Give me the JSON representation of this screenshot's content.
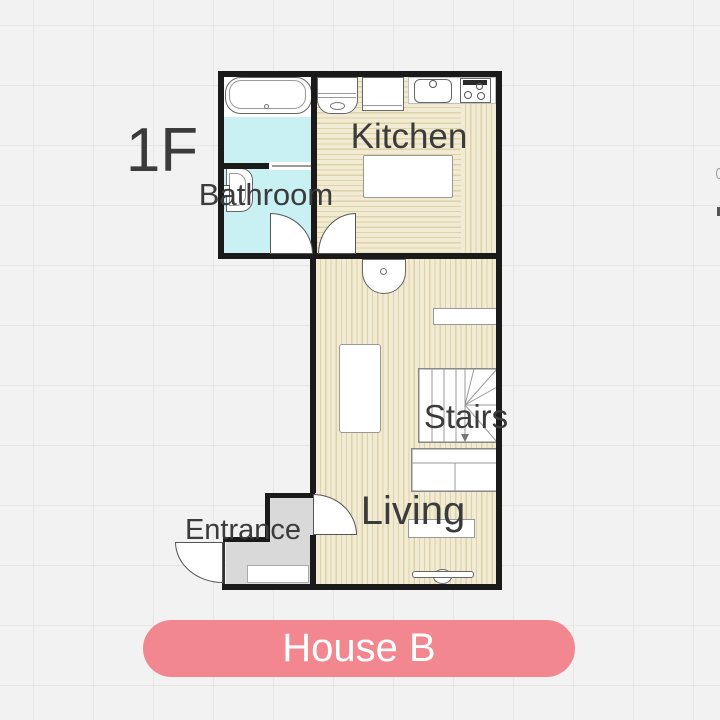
{
  "floor_plan": {
    "floor_label": "1F",
    "rooms": {
      "kitchen": "Kitchen",
      "bathroom": "Bathroom",
      "living": "Living",
      "stairs": "Stairs",
      "entrance": "Entrance"
    },
    "colors": {
      "wall": "#1a1a1a",
      "floor_wood_base": "#f2ebd3",
      "floor_wood_stripe": "#ded2aa",
      "floor_bathroom": "#c9f1f3",
      "floor_entrance": "#d9d9d9",
      "label_text": "#3b3b3b",
      "canvas_background": "#f2f2f2",
      "grid_line": "#e6e6e6"
    },
    "fixtures": [
      "bathtub",
      "washroom-basin",
      "sliding-door",
      "washing-machine",
      "refrigerator",
      "kitchen-counter",
      "kitchen-sink",
      "stove",
      "kitchen-table",
      "wash-basin",
      "shelf",
      "low-table",
      "staircase",
      "sofa",
      "tv-board",
      "tv",
      "genkan-step"
    ],
    "doors": [
      "bathroom-door",
      "kitchen-door",
      "living-door",
      "entrance-door"
    ]
  },
  "selector": {
    "house_button_label": "House B",
    "button_background": "#f28790",
    "button_text_color": "#ffffff"
  }
}
